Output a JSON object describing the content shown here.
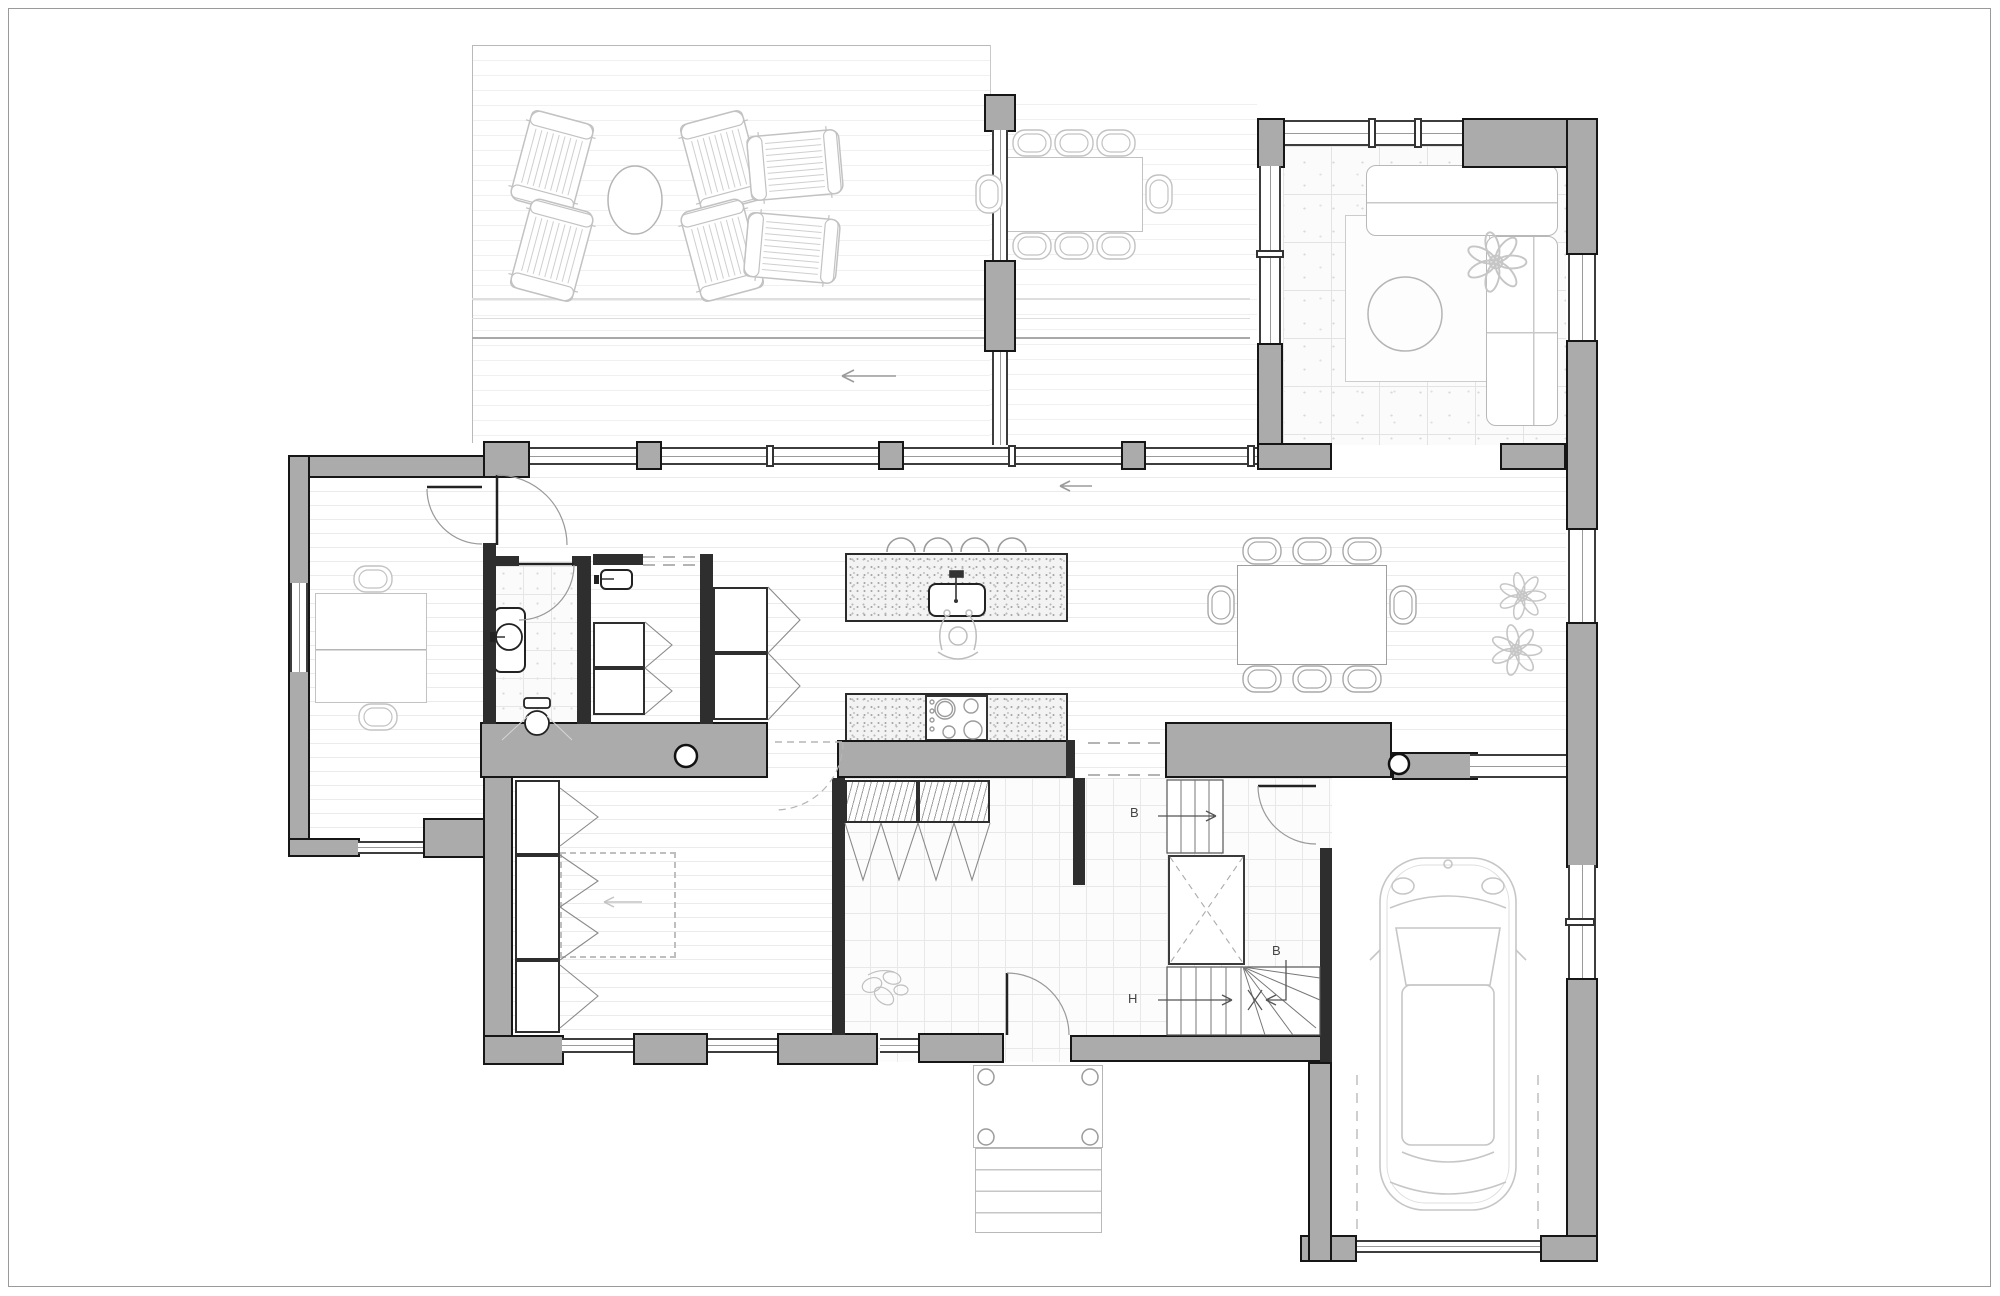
{
  "plan_type": "residential-floor-plan",
  "stairs": {
    "label_b_upper": "B",
    "label_b_lower": "B",
    "label_h": "H"
  },
  "colors": {
    "wall_fill": "#ababab",
    "wall_outline": "#161616",
    "partition": "#2e2e2e",
    "plank_line": "#ebebeb",
    "deck_line": "#f0f0f0",
    "tile_line": "#e3e3e3",
    "furniture_stroke": "#c2c2c2",
    "fixture_stroke": "#222222",
    "counter_fill": "#f3f3f3",
    "annotation": "#444444",
    "page_border": "#9a9a9a"
  },
  "icons": [
    "deck-round-table-icon",
    "lounge-chair-icon",
    "outdoor-dining-table-icon",
    "dining-chair-icon",
    "sofa-icon",
    "coffee-table-icon",
    "rug-icon",
    "plant-icon",
    "kitchen-island-icon",
    "sink-icon",
    "bar-stool-icon",
    "cooktop-icon",
    "person-icon",
    "desk-icon",
    "toilet-icon",
    "washbasin-icon",
    "shower-tray-icon",
    "wardrobe-icon",
    "hanging-clothes-icon",
    "stair-icon",
    "void-icon",
    "car-icon",
    "porch-steps-icon",
    "door-swing-icon"
  ]
}
